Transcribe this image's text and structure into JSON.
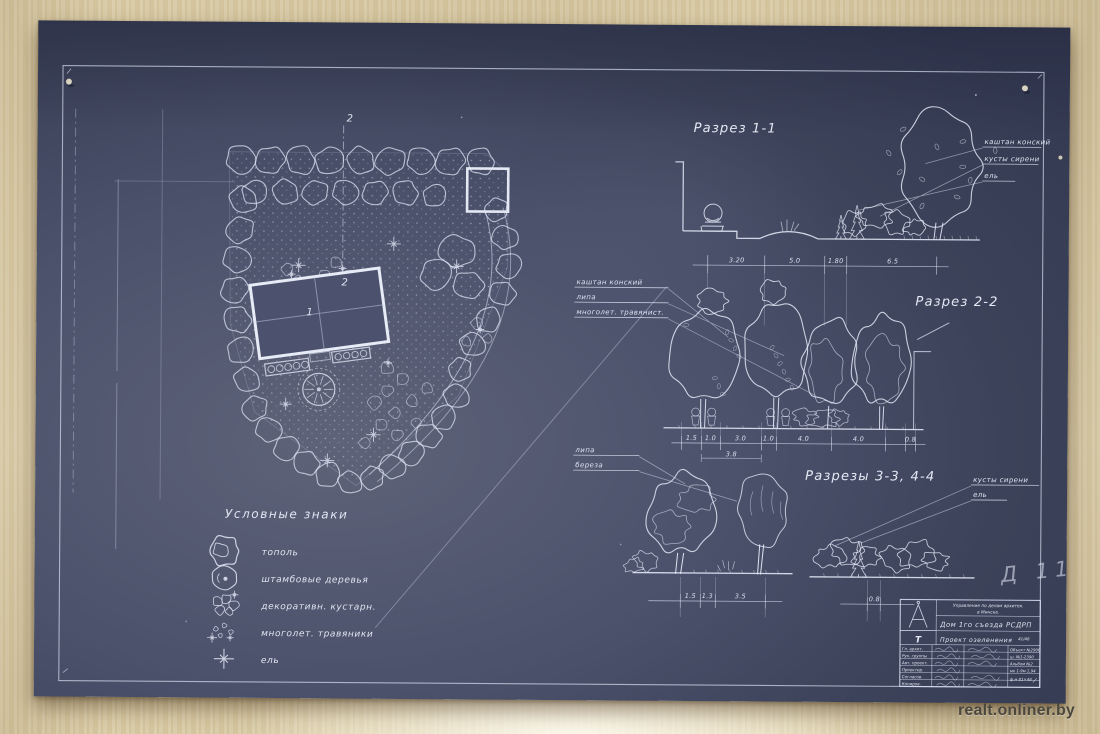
{
  "watermark": "realt.onliner.by",
  "pencil_note": "Д 11",
  "plan": {
    "section_marker_top": "2",
    "building_marker_a": "2",
    "building_marker_b": "1"
  },
  "legend": {
    "title": "Условные знаки",
    "items": [
      {
        "icon": "poplar-symbol",
        "label": "тополь"
      },
      {
        "icon": "standard-tree-symbol",
        "label": "штамбовые деревья"
      },
      {
        "icon": "shrub-symbol",
        "label": "декоративн. кустарн."
      },
      {
        "icon": "perennials-symbol",
        "label": "многолет. травяники"
      },
      {
        "icon": "spruce-symbol",
        "label": "ель"
      }
    ]
  },
  "section1": {
    "title": "Разрез 1-1",
    "callouts": [
      "каштан конский",
      "кусты сирени",
      "ель"
    ],
    "dims": [
      "3.20",
      "5.0",
      "1.80",
      "6.5"
    ]
  },
  "section2": {
    "title": "Разрез 2-2",
    "callouts": [
      "каштан конский",
      "липа",
      "многолет. травянист."
    ],
    "dims": [
      "1.5",
      "1.0",
      "3.0",
      "1.0",
      "4.0",
      "4.0",
      "0.8"
    ],
    "dim_sub": "3.8"
  },
  "section34": {
    "title": "Разрезы 3-3, 4-4",
    "callouts_left": [
      "липа",
      "береза"
    ],
    "callouts_right": [
      "кусты сирени",
      "ель"
    ],
    "dims_left": [
      "1.5",
      "1.3",
      "3.5"
    ],
    "dims_right": [
      "0.8"
    ]
  },
  "title_block": {
    "org1": "Управление по делам архитек.",
    "org2": "в Минске.",
    "project": "Дом 1го съезда РСДРП",
    "subject": "Проект озеленения",
    "sheet_no": "41/48",
    "type_mark": "Т",
    "roles": [
      "Гл. архит.",
      "Рук. группы",
      "Авт. проект.",
      "Проектир.",
      "Согласов.",
      "Копиров."
    ],
    "refs": [
      "Объект №2906",
      "ш. №1-2390",
      "Альбом №2",
      "мк 1-9м 1,94",
      "ф.м 81×48"
    ]
  }
}
